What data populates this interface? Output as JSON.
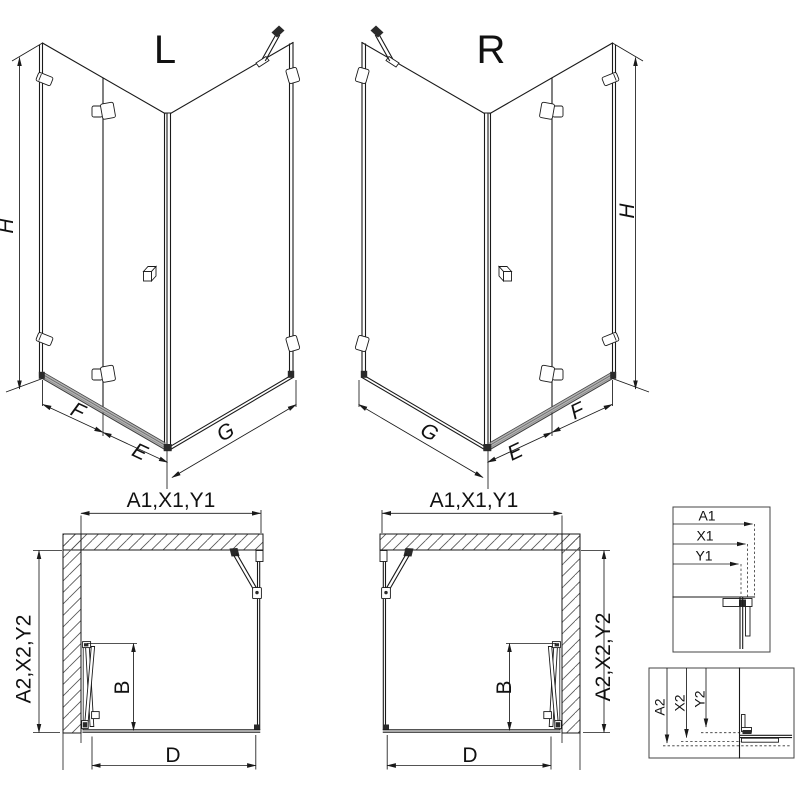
{
  "colors": {
    "line": "#1a1a1a",
    "text": "#111111",
    "rail_fill": "#b3b3b3",
    "hardware_dark": "#2a2a2a",
    "background": "#ffffff"
  },
  "iso_left": {
    "variant": "L",
    "dim_height": "H",
    "dim_f": "F",
    "dim_e": "E",
    "dim_g": "G"
  },
  "iso_right": {
    "variant": "R",
    "dim_height": "H",
    "dim_f": "F",
    "dim_e": "E",
    "dim_g": "G"
  },
  "plan_left": {
    "dim_width": "A1,X1,Y1",
    "dim_depth": "A2,X2,Y2",
    "dim_door": "B",
    "dim_entry": "D"
  },
  "plan_right": {
    "dim_width": "A1,X1,Y1",
    "dim_depth": "A2,X2,Y2",
    "dim_door": "B",
    "dim_entry": "D"
  },
  "inset_width": {
    "dims": [
      "A1",
      "X1",
      "Y1"
    ]
  },
  "inset_depth": {
    "dims": [
      "A2",
      "X2",
      "Y2"
    ]
  }
}
